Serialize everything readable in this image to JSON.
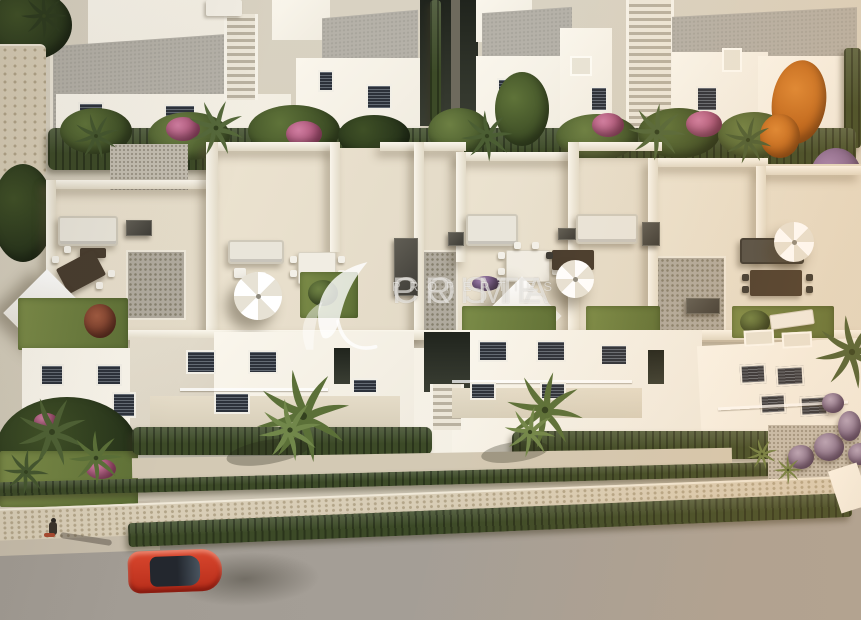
{
  "watermark": {
    "line1": "COSTA",
    "line2": "PRIME",
    "line3": "PROPERTIES"
  },
  "palette": {
    "wall-white": "#f0ebdf",
    "wall-bright": "#faf6ec",
    "wall-shade": "#d7cfbf",
    "roof-gray": "#b5b1a8",
    "tile": "#e2d9c6",
    "grass": "#5e7036",
    "hedge": "#3c4a27",
    "flower-pink": "#a84e72",
    "flower-purple": "#8a5f98",
    "tree-orange": "#b55c14",
    "stone": "#d8cdb6",
    "road": "#a8a29a",
    "sidewalk": "#c6bcaa",
    "car-red": "#b72d1a",
    "watermark-ink": "rgba(255,255,255,0.58)"
  }
}
